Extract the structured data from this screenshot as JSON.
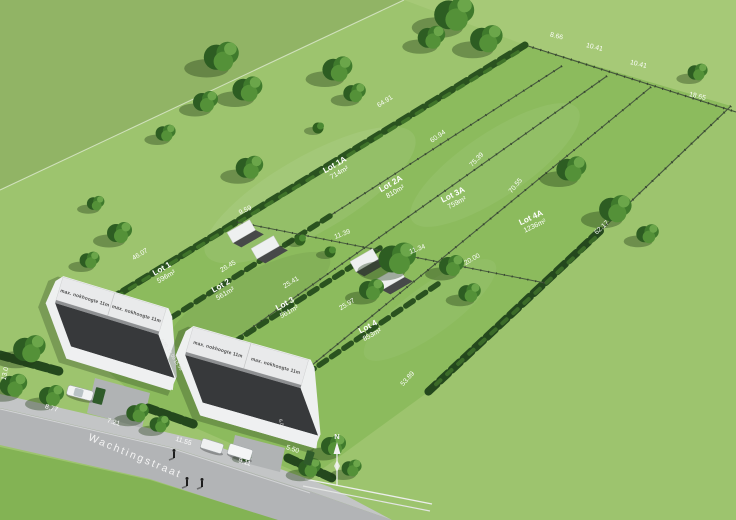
{
  "scene": {
    "description": "3D aerial site plan render of a residential land subdivision",
    "street": {
      "name": "Wachtingstraat"
    },
    "compass": {
      "label": "N"
    }
  },
  "houses": {
    "roof_label": "max. nokhoogte 11m",
    "dimensions": [
      "6.00",
      "12.00",
      "15.99",
      "6.00"
    ]
  },
  "lots": {
    "rear": [
      {
        "name": "Lot 1A",
        "area": "714m²"
      },
      {
        "name": "Lot 2A",
        "area": "810m²"
      },
      {
        "name": "Lot 3A",
        "area": "759m²"
      },
      {
        "name": "Lot 4A",
        "area": "1236m²"
      }
    ],
    "front": [
      {
        "name": "Lot 1",
        "area": "596m²"
      },
      {
        "name": "Lot 2",
        "area": "561m²"
      },
      {
        "name": "Lot 3",
        "area": "561m²"
      },
      {
        "name": "Lot 4",
        "area": "853m²"
      }
    ]
  },
  "measurements": {
    "rear_boundary": [
      "8.66",
      "10.41",
      "10.41",
      "18.65"
    ],
    "side_boundaries": [
      "64.91",
      "60.94",
      "75.39",
      "70.55",
      "62.17",
      "53.89"
    ],
    "front_depths": [
      "46.07",
      "26.45",
      "25.41",
      "25.97",
      "20.00"
    ],
    "mid_widths": [
      "9.59",
      "11.39",
      "11.34"
    ],
    "street_frontage": [
      "13.0",
      "8.77",
      "7.21",
      "11.55",
      "9.11",
      "5.50"
    ]
  },
  "colors": {
    "field_base": "#9dc46e",
    "field_dark": "#91b465",
    "field_far": "#a6c977",
    "parcel_grass": "#8cbb5d",
    "foreground_grass": "#83b354",
    "hedge_dark": "#24481d",
    "tree_green": "#3f7a2c",
    "road_grey": "#b2b4b6",
    "house_white": "#f0f1f2",
    "roof_dark": "#37393b",
    "label_white": "#ffffff"
  }
}
